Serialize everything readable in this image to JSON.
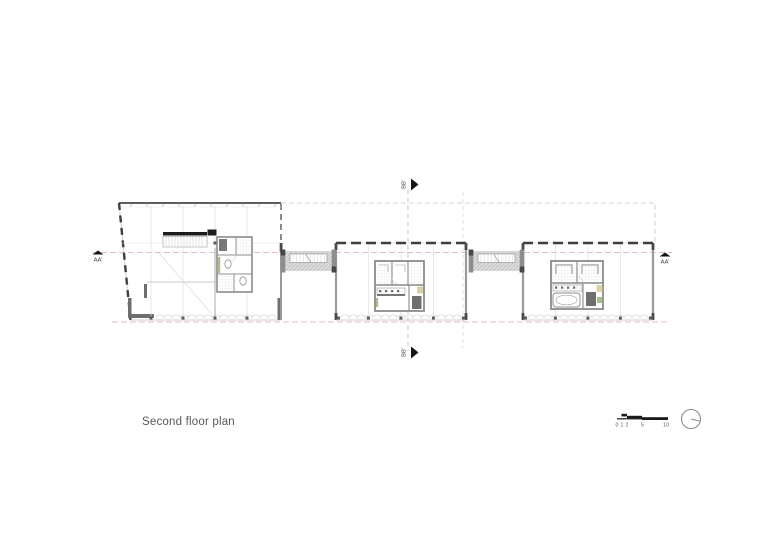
{
  "drawing": {
    "title": "Second floor plan",
    "section_markers": {
      "aa_left": "AA'",
      "aa_right": "AA'",
      "bb_top": "BB'",
      "bb_bottom": "BB'"
    },
    "scale_bar": {
      "ticks": [
        "0",
        "1",
        "2",
        "5",
        "10"
      ]
    },
    "icons": {
      "north": "north-arrow-icon",
      "section_cut": "section-arrow-icon"
    },
    "colors": {
      "background": "#ffffff",
      "wall_dark": "#3d3d3d",
      "wall_medium": "#8f8f8f",
      "line_light": "#d2d2d2",
      "hatch_fill": "#dadada",
      "section_line_red": "#dfa8a8",
      "accent_green": "#a9bd8c",
      "accent_yellow": "#d9d3a0",
      "label_text": "#4a4a4a"
    }
  }
}
